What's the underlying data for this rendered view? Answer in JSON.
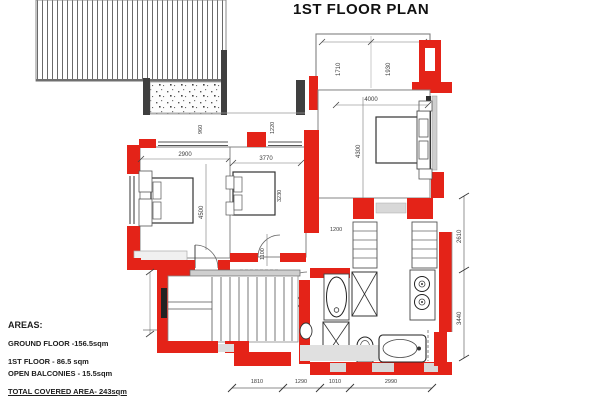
{
  "title": "1ST FLOOR PLAN",
  "areas": {
    "heading": "AREAS:",
    "ground_floor": "GROUND FLOOR -156.5sqm",
    "first_floor": "1ST FLOOR - 86.5 sqm",
    "open_balconies": "OPEN BALCONIES - 15.5sqm",
    "total": "TOTAL COVERED AREA- 243sqm"
  },
  "dimensions": {
    "terrace_left": "1710",
    "terrace_right": "1930",
    "master_width": "4000",
    "master_height": "4300",
    "bedroom1_width": "2900",
    "bedroom1_height": "4500",
    "bedroom2_width": "3770",
    "bedroom2_height": "3230",
    "offset_left": "960",
    "offset_mid": "1220",
    "corridor_width": "1100",
    "hall_width": "1200",
    "right_upper": "2610",
    "right_lower": "3440",
    "bottom": [
      "1810",
      "1290",
      "1010",
      "2990"
    ]
  },
  "colors": {
    "wall_red": "#e42318",
    "wall_dark": "#3f3f3f",
    "slab_gray": "#d8d8d8"
  }
}
